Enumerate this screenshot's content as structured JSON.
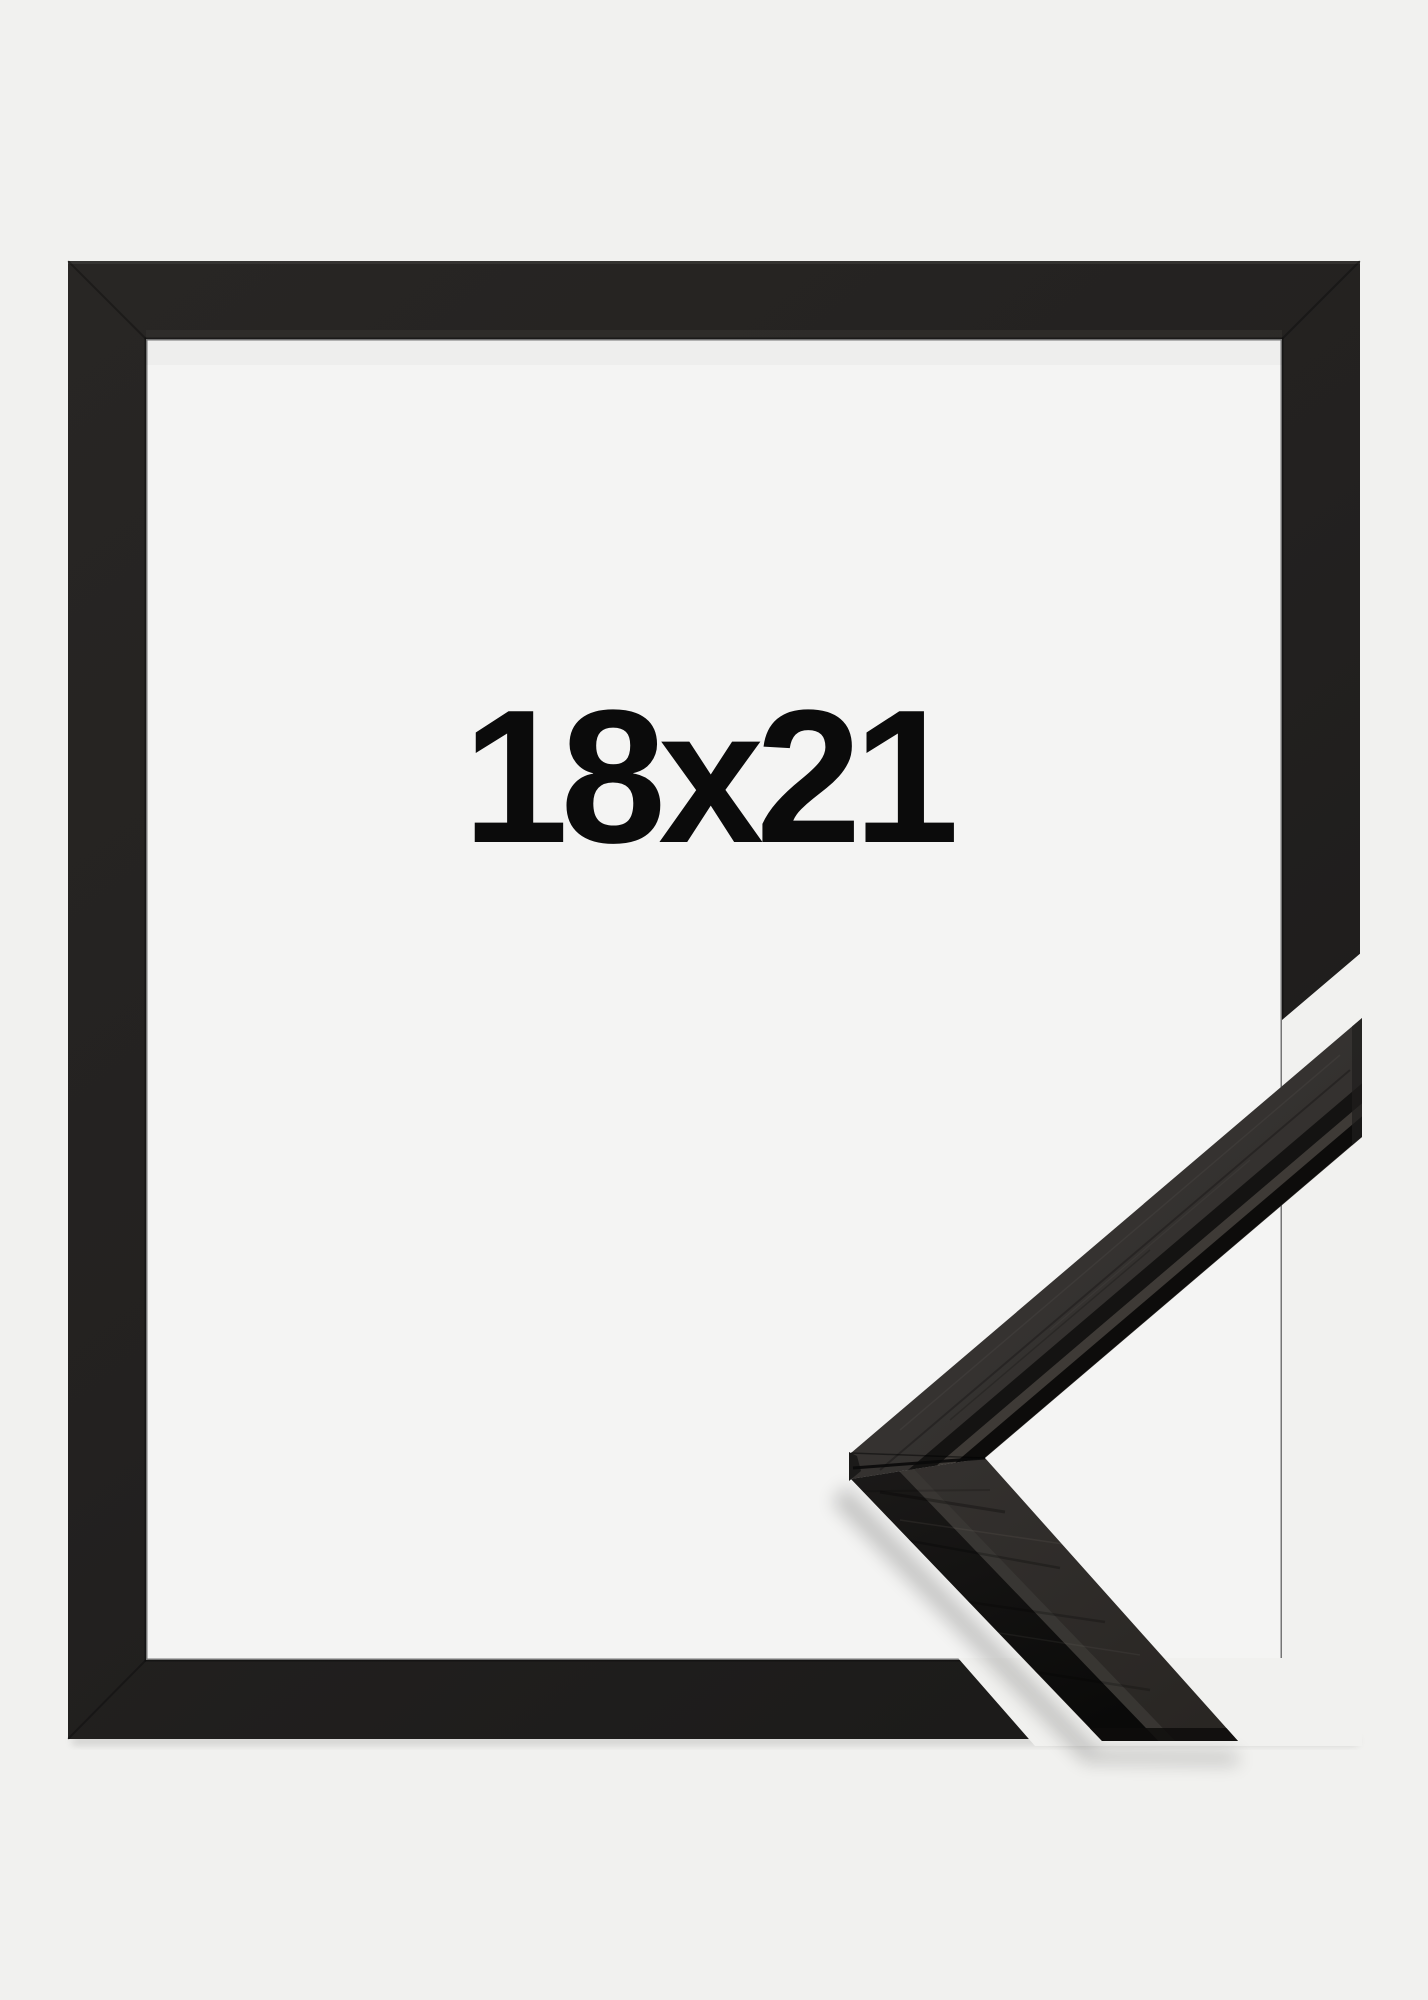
{
  "product": {
    "size_label": "18x21"
  },
  "scene": {
    "description_names": {
      "flat_frame": "black-frame-front-view",
      "corner_sample": "frame-moulding-corner-profile-3d"
    }
  },
  "colors": {
    "background": "#f1f1ef",
    "opening_interior": "#f4f4f3",
    "frame_black": "#262422",
    "frame_black_dark": "#1b1a19",
    "moulding_surface_light": "#393633",
    "moulding_surface": "#2e2b28",
    "rabbet_groove": "#141312",
    "rabbet_lip_highlight": "#3e3a36",
    "moulding_edge_dark": "#0d0c0b",
    "moulding_front_face": "#151312",
    "label_text": "#0b0b0b"
  }
}
